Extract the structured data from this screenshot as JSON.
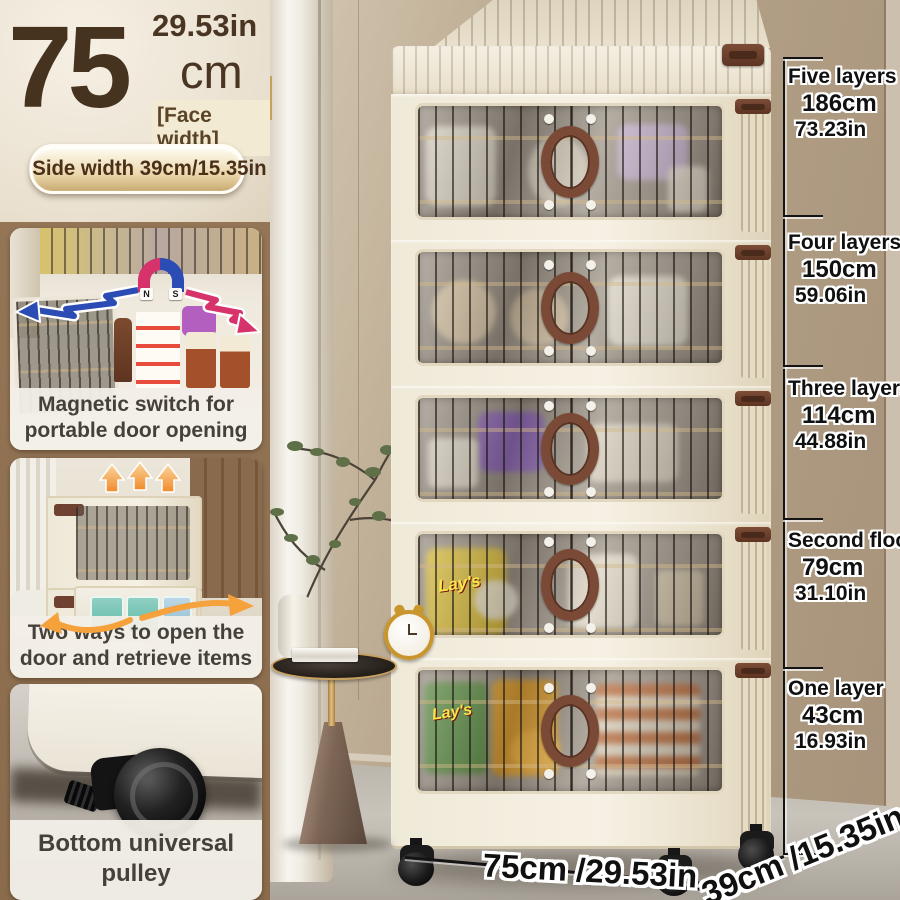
{
  "header": {
    "face_width_value": "75",
    "face_width_inches": "29.53in",
    "face_width_unit": "cm",
    "face_width_label": "[Face width]",
    "side_width_pill": "Side width 39cm/15.35in"
  },
  "features": [
    {
      "caption_line1": "Magnetic switch for",
      "caption_line2": "portable door opening",
      "magnet": {
        "n": "N",
        "s": "S"
      }
    },
    {
      "caption_line1": "Two ways to open the",
      "caption_line2": "door and retrieve items"
    },
    {
      "caption_line1": "Bottom universal pulley"
    }
  ],
  "height_annotations": [
    {
      "label": "Five layers",
      "cm": "186cm",
      "inches": "73.23in"
    },
    {
      "label": "Four layers",
      "cm": "150cm",
      "inches": "59.06in"
    },
    {
      "label": "Three layers",
      "cm": "114cm",
      "inches": "44.88in"
    },
    {
      "label": "Second floor",
      "cm": "79cm",
      "inches": "31.10in"
    },
    {
      "label": "One layer",
      "cm": "43cm",
      "inches": "16.93in"
    }
  ],
  "bottom_dimensions": {
    "width": "75cm /29.53in",
    "depth": "39cm /15.35in"
  },
  "cabinet": {
    "tier_count": 5,
    "chips_brand": "Lay's"
  },
  "colors": {
    "accent_brown": "#8E6F4F",
    "text_brown": "#45321F",
    "cabinet_cream": "#F2ECDD",
    "handle_brown": "#7A4A36",
    "magnet_blue": "#2B4BB5",
    "magnet_red": "#D6336B",
    "arrow_orange": "#F5A23C",
    "annotation_black": "#111111"
  }
}
